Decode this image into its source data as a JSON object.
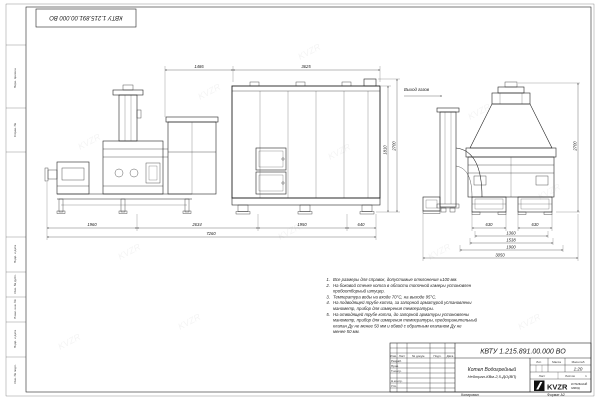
{
  "sheet": {
    "stamp": "КВТУ 1.215.891.00.000 ВО",
    "watermark": "KVZR",
    "copy_label": "Копировал",
    "format_label": "Формат А2"
  },
  "margin": {
    "labels": [
      "Перв. примен.",
      "Справ. №",
      "Подп. и дата",
      "Инв. № дубл.",
      "Взам. инв. №",
      "Подп. и дата",
      "Инв. № подл."
    ]
  },
  "drawing": {
    "gas_outlet_label": "Выход газов",
    "dims": {
      "top_left": "1486",
      "top_right": "3625",
      "chain": [
        "1960",
        "2634",
        "1950",
        "640"
      ],
      "total_bottom": "7260",
      "height_inner": "1810",
      "height_outer": "2700",
      "end_630_left": "630",
      "end_630_right": "630",
      "end_1360": "1360",
      "end_1538": "1538",
      "end_1900": "1900",
      "end_total": "3050",
      "end_height": "2700"
    }
  },
  "notes": {
    "items": [
      {
        "num": "1.",
        "lines": [
          "Все размеры для справок, допустимые отклонения ±100 мм."
        ]
      },
      {
        "num": "2.",
        "lines": [
          "На боковой стенке котла в области топочной камеры установлен",
          "пробоотборный штуцер."
        ]
      },
      {
        "num": "3.",
        "lines": [
          "Температура воды на входе 70°С, на выходе 95°С."
        ]
      },
      {
        "num": "4.",
        "lines": [
          "На подводящей трубе котла, за запорной арматурой установлены",
          "манометр, прибор для измерения температуры."
        ]
      },
      {
        "num": "5.",
        "lines": [
          "На отводящей трубе котла, до запорной арматуры установлены",
          "манометр, прибор для измерения температуры, предохранительный",
          "клапан Ду не менее 50 мм и обвод с обратным клапаном Ду не",
          "менее 50 мм."
        ]
      }
    ]
  },
  "title_block": {
    "doc_number": "КВТУ 1.215.891.00.000 ВО",
    "name_line1": "Котел Водогрейный",
    "name_line2": "Нейтрал-КВм-2,5-ДО(ВП)",
    "header": {
      "izm": "Изм.",
      "list": "Лист",
      "doc": "№ докум.",
      "podp": "Подп.",
      "data": "Дата"
    },
    "roles": [
      "Разраб.",
      "Пров.",
      "Т.контр.",
      "Н.контр.",
      "Утв."
    ],
    "lit_label": "Лит.",
    "mass_label": "Масса",
    "scale_label": "Масштаб",
    "scale_value": "1:20",
    "sheet_label": "Лист",
    "sheets_label": "Листов",
    "sheets_value": "1",
    "logo_text": "KVZR",
    "logo_sub1": "КОТЕЛЬНЫЙ",
    "logo_sub2": "ЗАВОД"
  }
}
